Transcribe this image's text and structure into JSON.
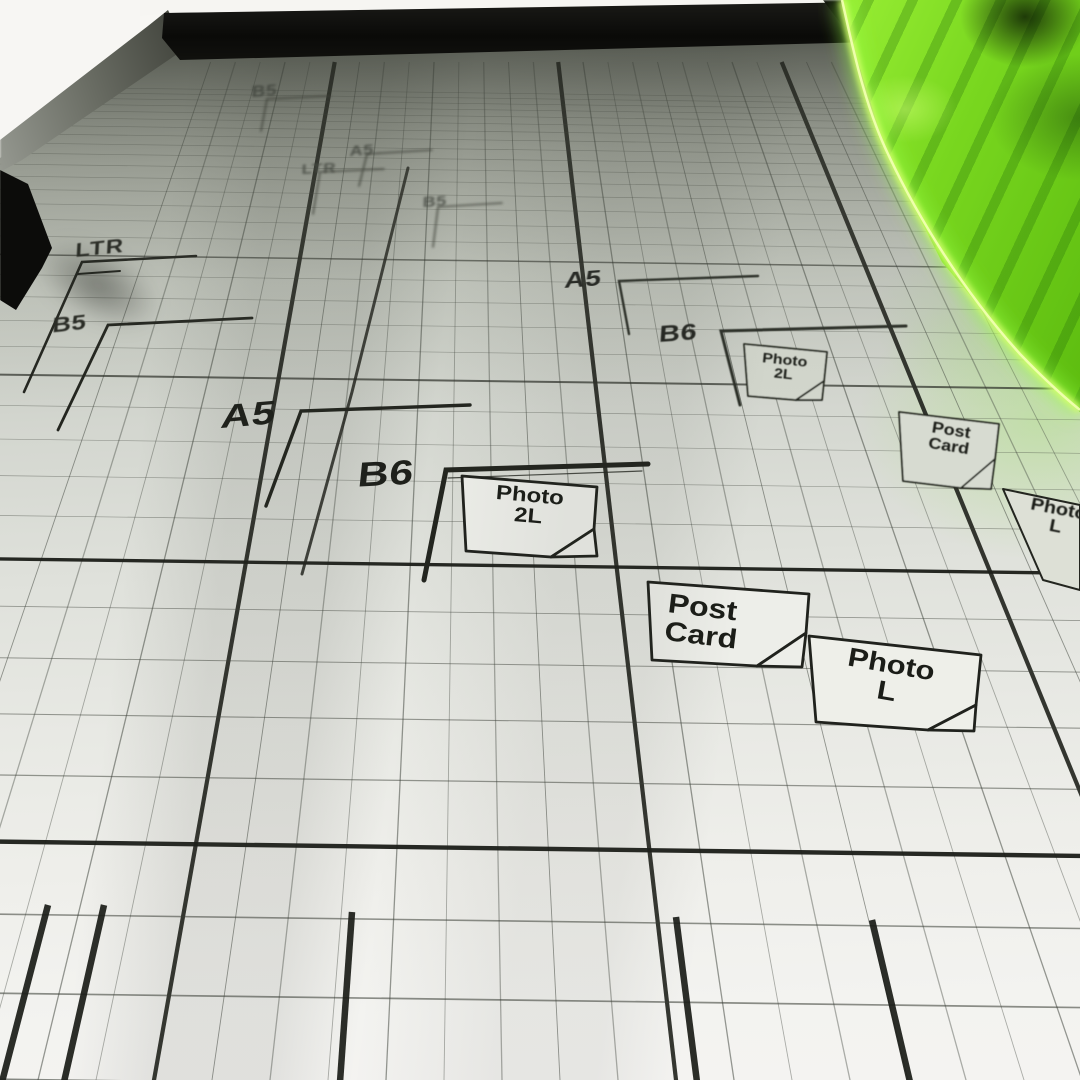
{
  "scene": {
    "description": "Close-up photo of a paper trimmer cutting base: printed alignment grid with paper-size guides, black clamp bar, and translucent neon-green blade guard",
    "colors": {
      "background_white": "#f7f6f3",
      "mat_light": "#efefeb",
      "mat_shadow": "#565a50",
      "grid_line": "#454a42",
      "major_line": "#1c1e19",
      "ink": "#1d1f1a",
      "guard_green": "#79d71f",
      "guard_edge_glow": "#d2ff6a",
      "clamp_black": "#0c0c0a",
      "rail_gray": "#878a80"
    }
  },
  "size_markings": {
    "far": {
      "b5_top": "B5",
      "a5": "A5",
      "ltr": "LTR",
      "b5": "B5"
    },
    "near_left": {
      "ltr": "LTR",
      "b5": "B5"
    },
    "mid": {
      "a5": "A5",
      "b6": "B6",
      "photo_2l": [
        "Photo",
        "2L"
      ],
      "post_card": [
        "Post",
        "Card"
      ],
      "photo_l": [
        "Photo",
        "L"
      ]
    },
    "near": {
      "a5": "A5",
      "b6": "B6",
      "photo_2l": [
        "Photo",
        "2L"
      ],
      "post_card": [
        "Post",
        "Card"
      ],
      "photo_l": [
        "Photo",
        "L"
      ]
    }
  }
}
